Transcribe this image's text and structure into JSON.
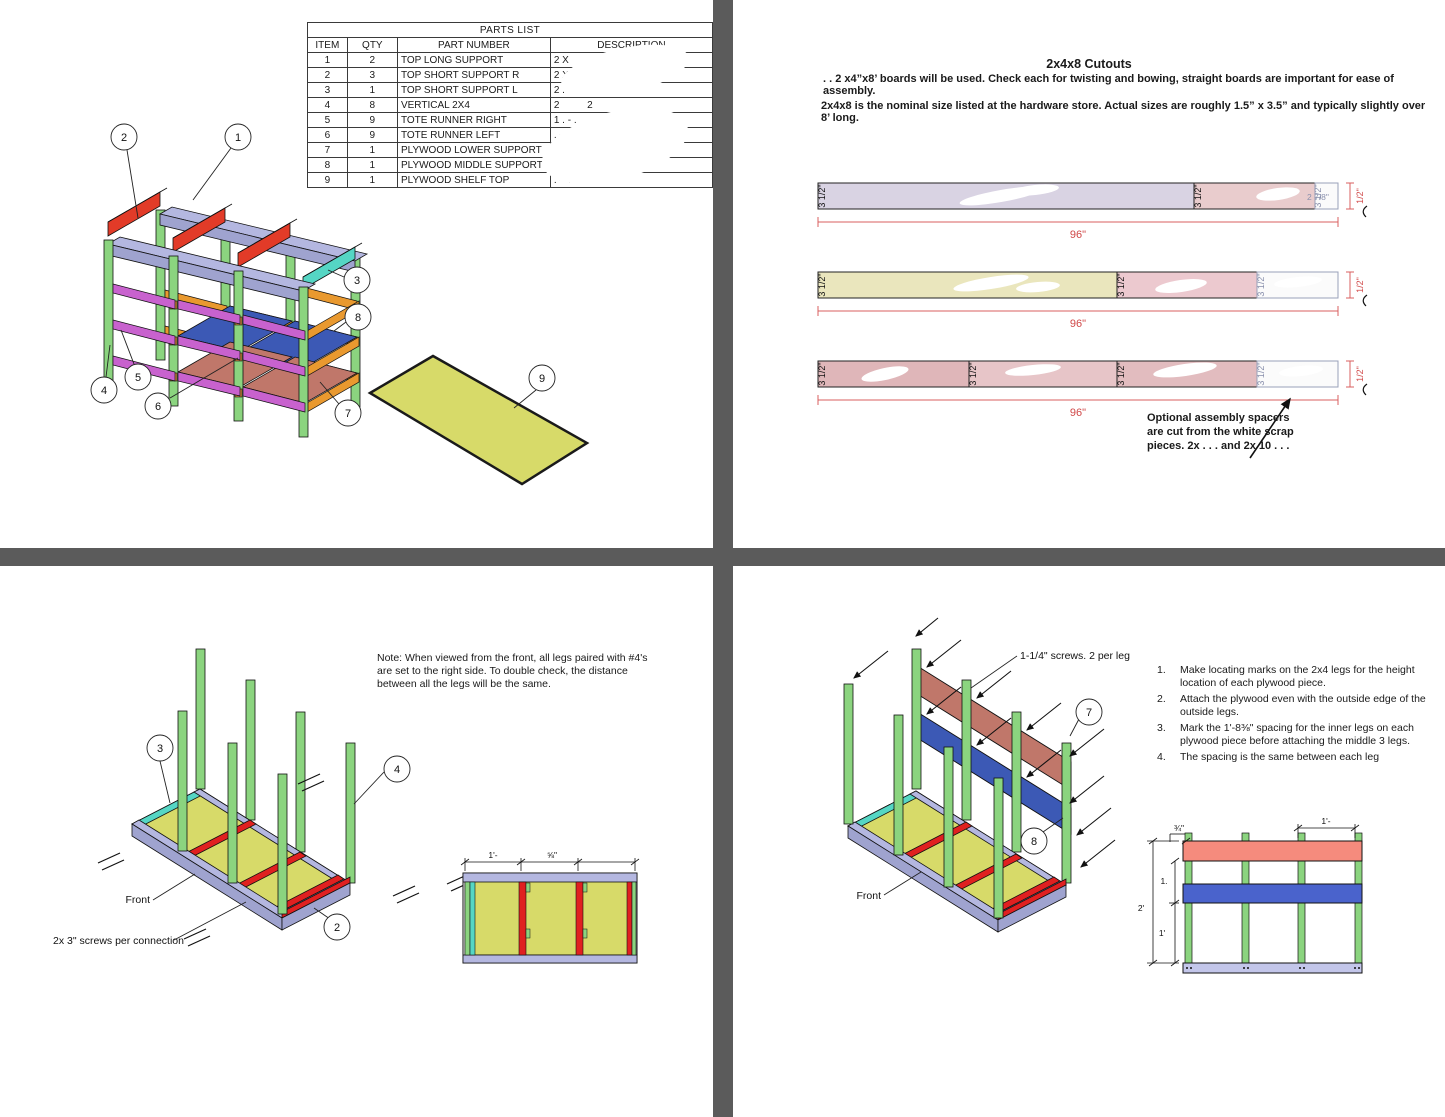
{
  "page1": {
    "parts_list": {
      "title": "PARTS LIST",
      "col_item": "ITEM",
      "col_qty": "QTY",
      "col_part": "PART NUMBER",
      "col_desc": "DESCRIPTION",
      "rows": [
        {
          "item": "1",
          "qty": "2",
          "part": "TOP LONG SUPPORT",
          "desc": "2 X"
        },
        {
          "item": "2",
          "qty": "3",
          "part": "TOP SHORT SUPPORT R",
          "desc": "2 X 4 X"
        },
        {
          "item": "3",
          "qty": "1",
          "part": "TOP SHORT SUPPORT L",
          "desc": "2 . -"
        },
        {
          "item": "4",
          "qty": "8",
          "part": "VERTICAL 2X4",
          "desc": "2          2"
        },
        {
          "item": "5",
          "qty": "9",
          "part": "TOTE RUNNER RIGHT",
          "desc": "1 . - ."
        },
        {
          "item": "6",
          "qty": "9",
          "part": "TOTE RUNNER LEFT",
          "desc": ". -"
        },
        {
          "item": "7",
          "qty": "1",
          "part": "PLYWOOD LOWER SUPPORT",
          "desc": ". .   1("
        },
        {
          "item": "8",
          "qty": "1",
          "part": "PLYWOOD MIDDLE SUPPORT",
          "desc": ". -"
        },
        {
          "item": "9",
          "qty": "1",
          "part": "PLYWOOD SHELF TOP",
          "desc": ". -  . ."
        }
      ]
    },
    "callouts": {
      "c1": "1",
      "c2": "2",
      "c3": "3",
      "c4": "4",
      "c5": "5",
      "c6": "6",
      "c7": "7",
      "c8": "8",
      "c9": "9"
    }
  },
  "page2": {
    "title": "2x4x8 Cutouts",
    "para1_lead": ". .",
    "para1": "x4”x8’ boards will be used. Check each for twisting and bowing, straight boards are important for ease of assembly.",
    "para1_mid": "2",
    "para2": "2x4x8 is the nominal size listed at the hardware store. Actual sizes are roughly 1.5” x 3.5” and typically slightly over 8’ long.",
    "width_label": "3 1/2\"",
    "length_label": "96\"",
    "end_width_label": "1/2\"",
    "scrap_label": "2 7/8\"",
    "spacer_note_line1": "Optional assembly spacers",
    "spacer_note_line2": "are cut from the white scrap",
    "spacer_note_line3": "pieces. 2x . . .   and 2x 10 . . ."
  },
  "page3": {
    "note_line1": "Note: When viewed from the front, all legs paired with #4's",
    "note_line2": "are set to the right side. To double check, the distance",
    "note_line3": "between all the legs will be the same.",
    "front_label": "Front",
    "screws_label": "2x 3\" screws per connection",
    "callout_2": "2",
    "callout_3": "3",
    "callout_4": "4",
    "dim_seg1": "1'-",
    "dim_seg2": "⅝\"",
    "dim_seg3": ""
  },
  "page4": {
    "screws_label": "1-1/4\" screws. 2 per leg",
    "front_label": "Front",
    "callout_7": "7",
    "callout_8": "8",
    "steps": [
      {
        "num": "1.",
        "text": "Make locating marks on the 2x4 legs for the height location of each plywood piece."
      },
      {
        "num": "2.",
        "text": "Attach the plywood even with the outside edge of the outside legs."
      },
      {
        "num": "3.",
        "text": "Mark the 1'-8⅜\" spacing for the inner legs on each plywood piece before attaching the middle 3 legs."
      },
      {
        "num": "4.",
        "text": "The spacing is the same between each leg"
      }
    ],
    "dim_top": "¾\"",
    "dim_outer": "2'",
    "dim_mid1": "1.",
    "dim_mid2": "1'",
    "dim_topright": "1'-"
  }
}
